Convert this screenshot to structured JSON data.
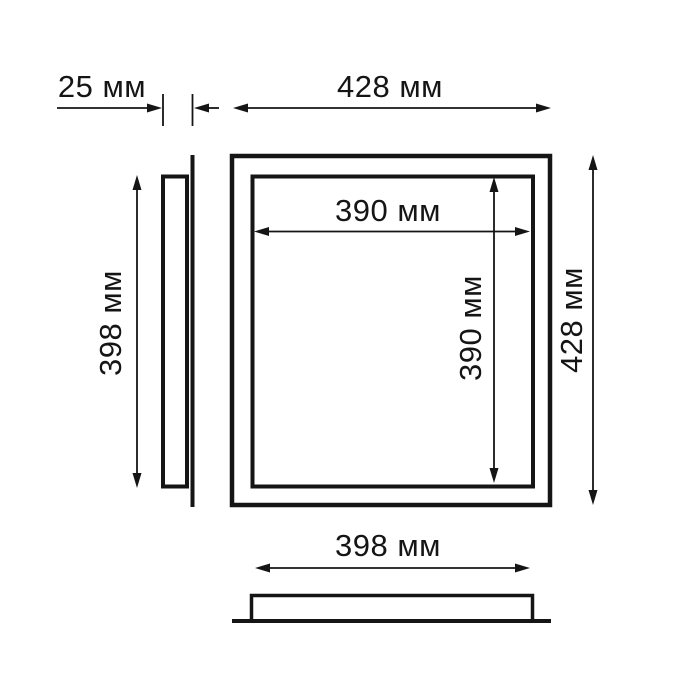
{
  "drawing": {
    "unit": "мм",
    "line_color": "#151515",
    "background_color": "#ffffff",
    "dimensions": {
      "frame_depth": {
        "value": 25,
        "label": "25 мм"
      },
      "outer_width": {
        "value": 428,
        "label": "428 мм"
      },
      "outer_height": {
        "value": 428,
        "label": "428 мм"
      },
      "opening_width": {
        "value": 390,
        "label": "390 мм"
      },
      "opening_height": {
        "value": 390,
        "label": "390 мм"
      },
      "body_height": {
        "value": 398,
        "label": "398 мм"
      },
      "body_width": {
        "value": 398,
        "label": "398 мм"
      }
    }
  }
}
